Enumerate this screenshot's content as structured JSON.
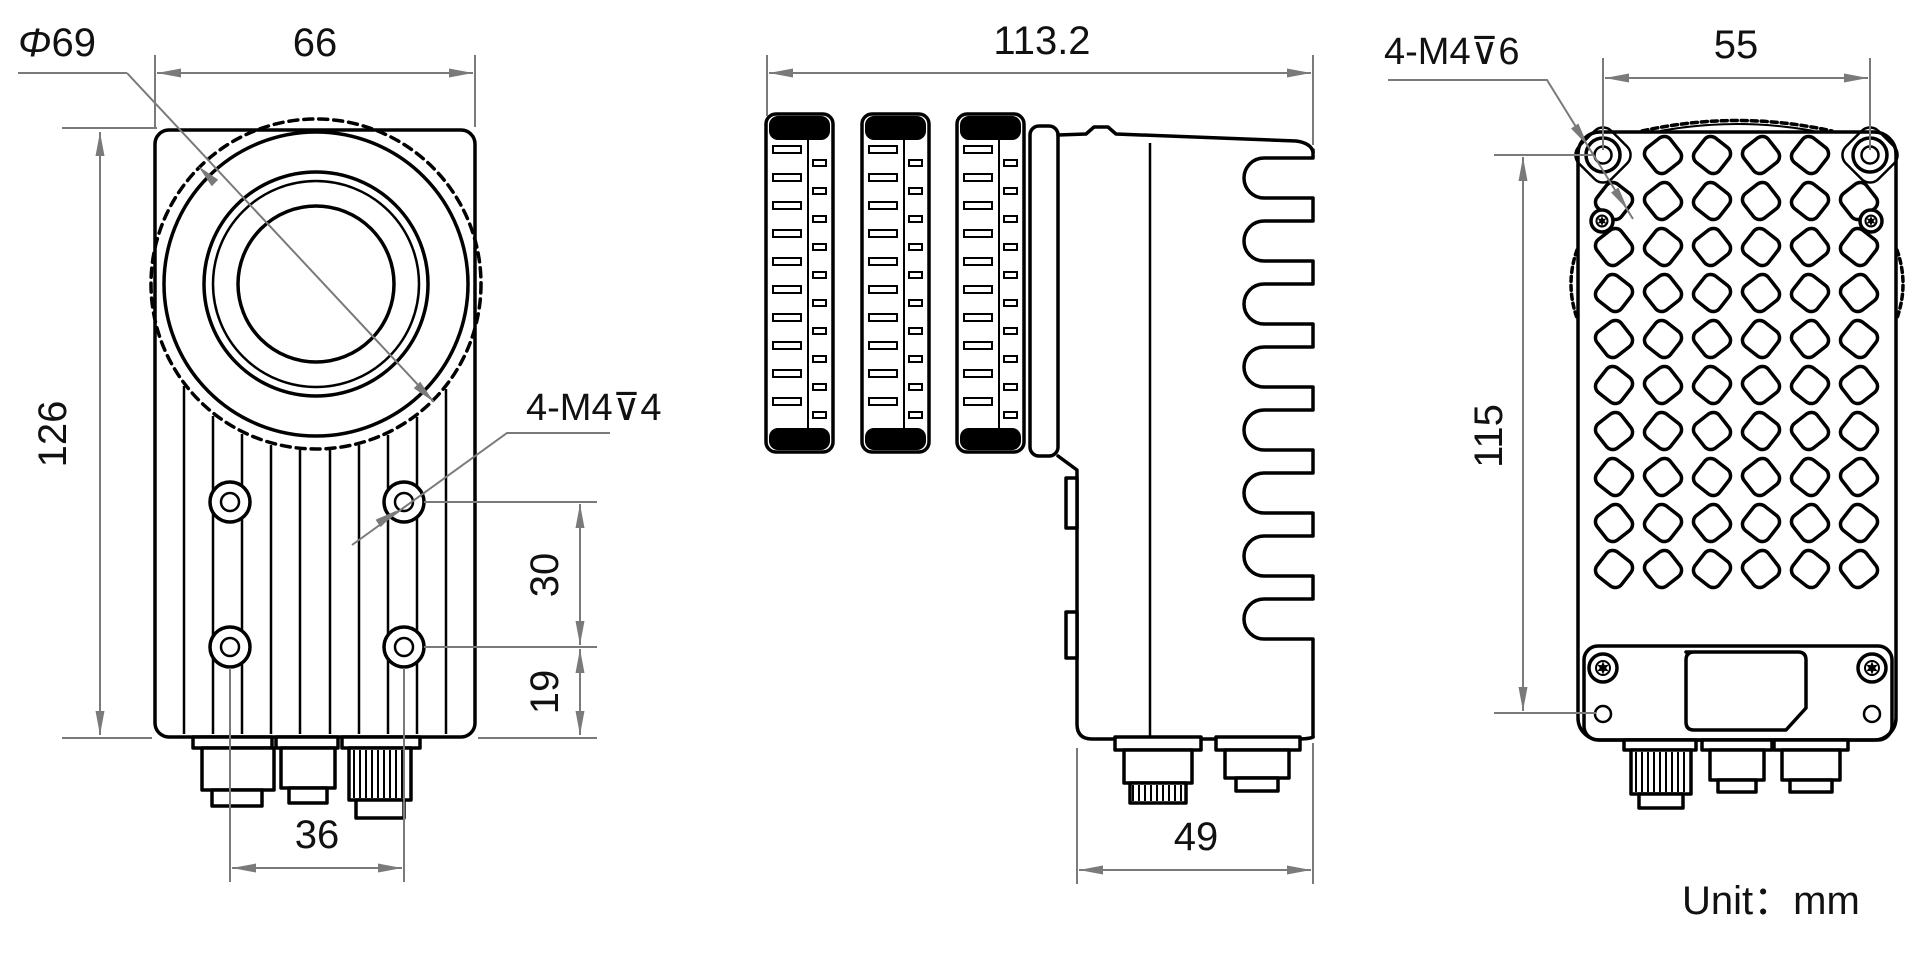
{
  "unit_note": "Unit：mm",
  "front_view": {
    "lens_diameter_symbol": "Φ",
    "lens_diameter_value": "69",
    "width_label": "66",
    "height_label": "126",
    "screw_label": "4-M4⊽4",
    "upper_hole_spacing_label": "30",
    "lower_hole_offset_label": "19",
    "bottom_hole_spacing_label": "36"
  },
  "side_view": {
    "length_label": "113.2",
    "depth_label": "49"
  },
  "back_view": {
    "screw_label": "4-M4⊽6",
    "hole_spacing_horizontal_label": "55",
    "hole_spacing_vertical_label": "115"
  },
  "colors": {
    "line": "#000000",
    "dimension": "#7a7a7a",
    "background": "#ffffff"
  }
}
